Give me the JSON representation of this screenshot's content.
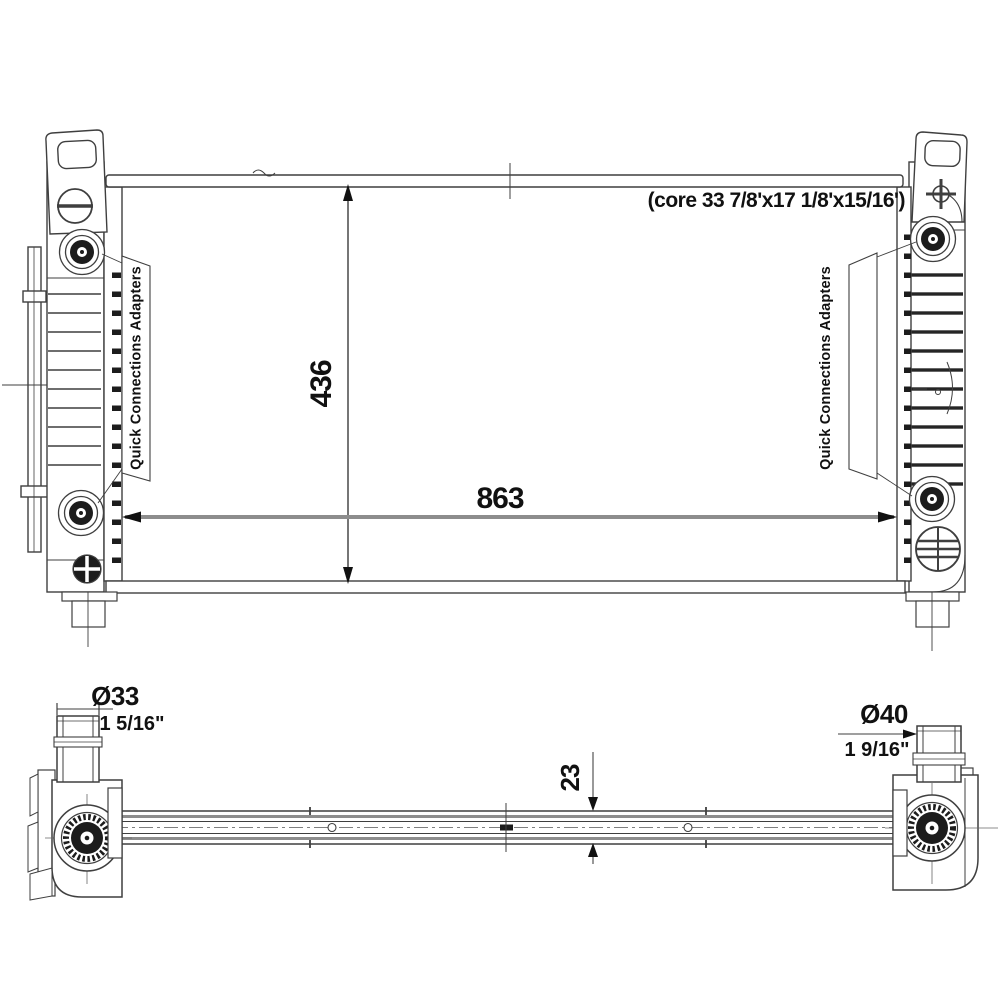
{
  "drawing": {
    "front_view": {
      "core_note": "(core 33 7/8'x17 1/8'x15/16')",
      "height_dim": "436",
      "width_dim": "863",
      "left_callout_label": "Quick Connections Adapters",
      "right_callout_label": "Quick Connections Adapters"
    },
    "profile_view": {
      "thickness_dim": "23",
      "inlet_diameter": "Ø33",
      "inlet_diameter_inches": "1 5/16\"",
      "outlet_diameter": "Ø40",
      "outlet_diameter_inches": "1 9/16\""
    },
    "colors": {
      "line": "#3f3f3f",
      "dim_line": "#8d8d8d",
      "fitting_fill": "#1c1c1c",
      "text": "#111111",
      "background": "#ffffff"
    }
  }
}
